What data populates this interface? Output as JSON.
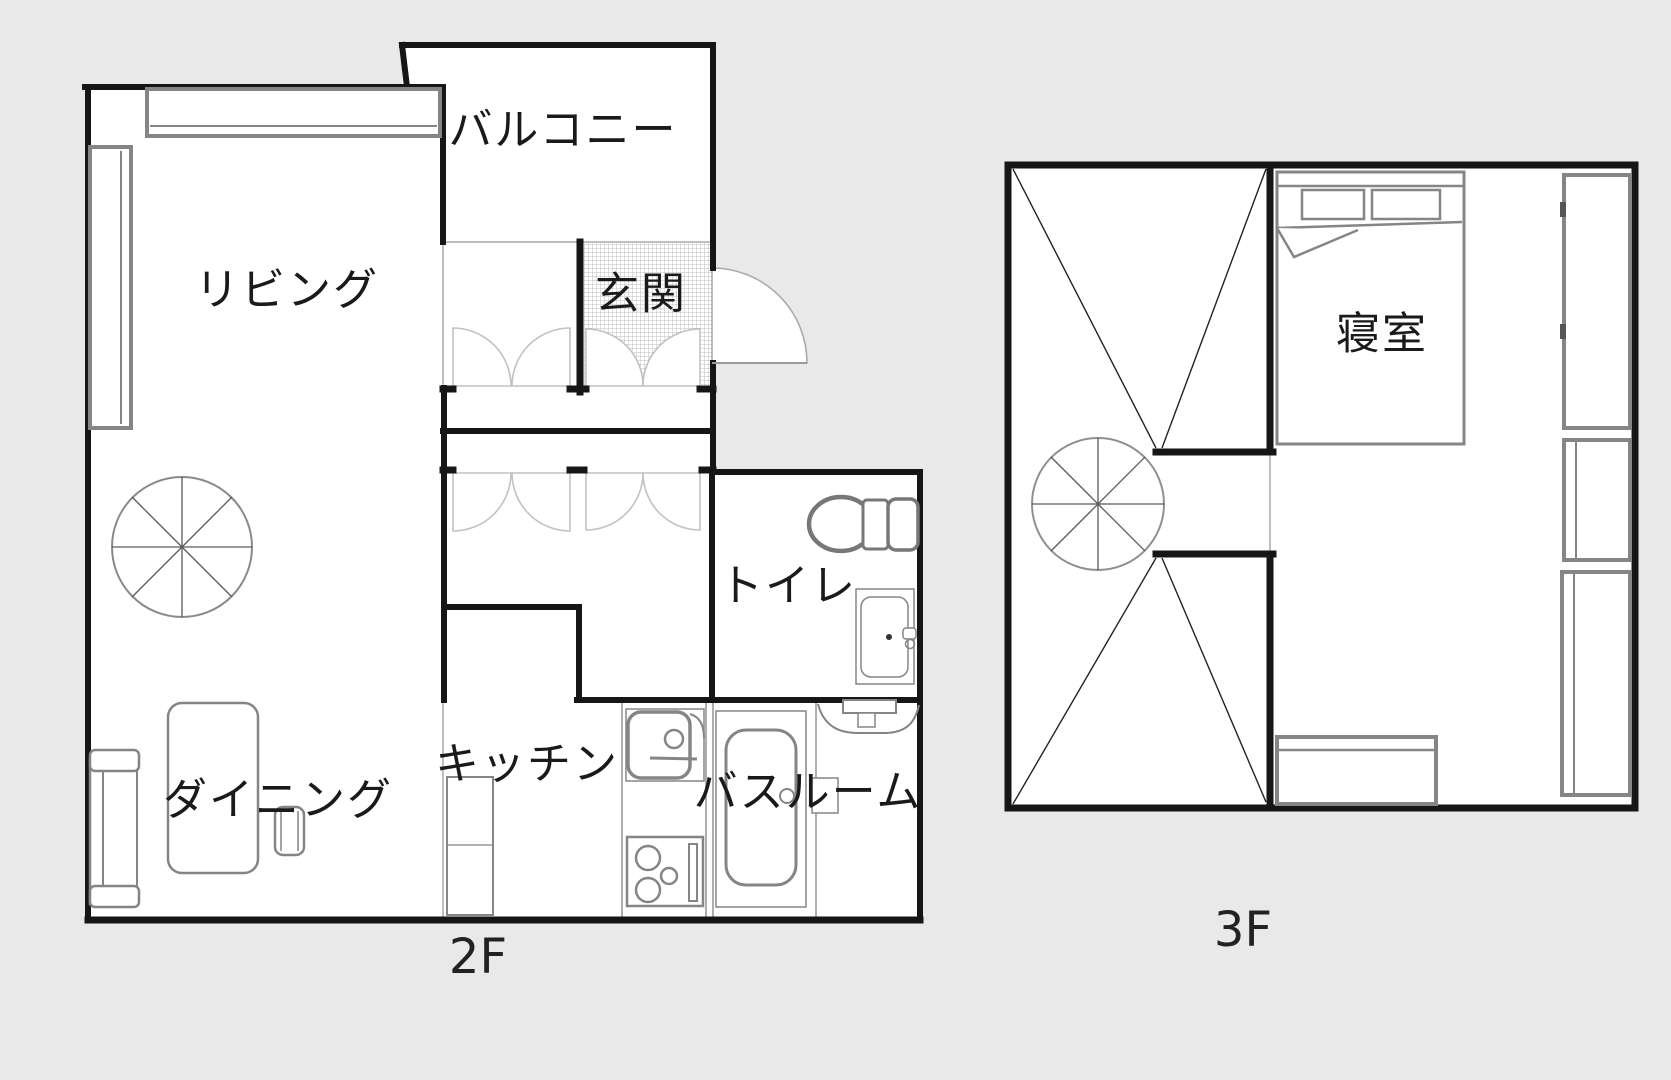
{
  "title": "floor-plan",
  "colors": {
    "background": "#e9e9e9",
    "walls": "#161616",
    "furniture": "#858585",
    "text": "#1a1a1a",
    "hatch": "#bdbdbd"
  },
  "floors": [
    {
      "id": "2F",
      "label": "2F",
      "rooms": [
        {
          "name": "living",
          "label": "リビング"
        },
        {
          "name": "balcony",
          "label": "バルコニー"
        },
        {
          "name": "genkan",
          "label": "玄関"
        },
        {
          "name": "toilet",
          "label": "トイレ"
        },
        {
          "name": "kitchen",
          "label": "キッチン"
        },
        {
          "name": "dining",
          "label": "ダイニング"
        },
        {
          "name": "bathroom",
          "label": "バスルーム"
        }
      ]
    },
    {
      "id": "3F",
      "label": "3F",
      "rooms": [
        {
          "name": "bedroom",
          "label": "寝室"
        }
      ]
    }
  ]
}
